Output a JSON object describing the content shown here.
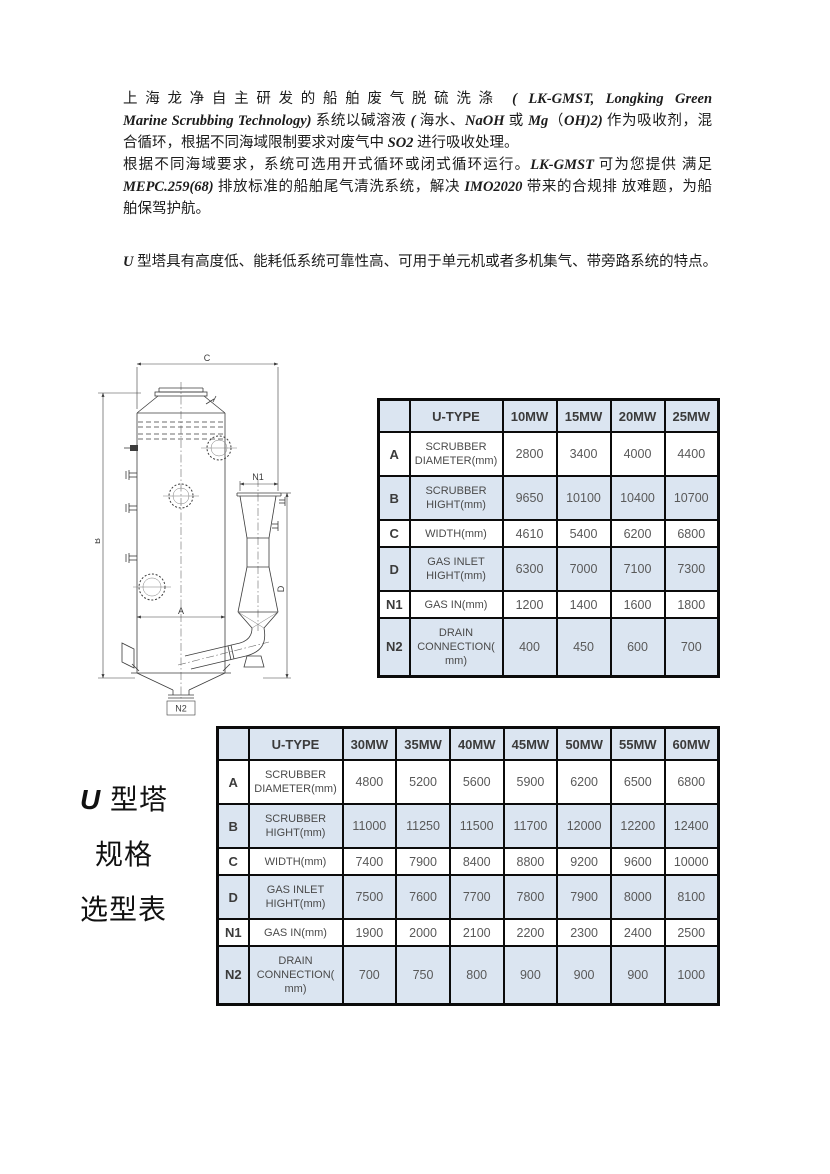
{
  "colors": {
    "table_fill_blue": "#dbe5f1",
    "table_border": "#0b0b0b",
    "value_text": "#595959",
    "body_text": "#1c1c1c"
  },
  "intro": {
    "para1_lines": [
      "上海龙净自主研发的船舶废气脱硫洗涤 ( LK-GMST, Longking Green",
      "Marine Scrubbing Technology) 系统以碱溶液 ( 海水、NaOH 或 Mg（OH)2) 作为吸收剂，混",
      "合循环，根据不同海域限制要求对废气中 SO2 进行吸收处理。"
    ],
    "para2_lines": [
      "根据不同海域要求，系统可选用开式循环或闭式循环运行。LK-GMST 可为您提供 满足",
      "MEPC.259(68) 排放标准的船舶尾气清洗系统，解决 IMO2020 带来的合规排 放难题，为船",
      "舶保驾护航。"
    ],
    "feature_line": "U 型塔具有高度低、能耗低系统可靠性高、可用于单元机或者多机集气、带旁路系统的特点。"
  },
  "drawing": {
    "labels": {
      "c": "C",
      "b": "B",
      "a": "A",
      "d": "D",
      "n1": "N1",
      "n2": "N2"
    }
  },
  "side_label": {
    "lines": [
      "U 型塔",
      "规格",
      "选型表"
    ]
  },
  "table1": {
    "header": [
      "",
      "U-TYPE",
      "10MW",
      "15MW",
      "20MW",
      "25MW"
    ],
    "rows": [
      {
        "key": "A",
        "param": "SCRUBBER DIAMETER(mm)",
        "values": [
          "2800",
          "3400",
          "4000",
          "4400"
        ]
      },
      {
        "key": "B",
        "param": "SCRUBBER HIGHT(mm)",
        "values": [
          "9650",
          "10100",
          "10400",
          "10700"
        ]
      },
      {
        "key": "C",
        "param": "WIDTH(mm)",
        "values": [
          "4610",
          "5400",
          "6200",
          "6800"
        ]
      },
      {
        "key": "D",
        "param": "GAS INLET HIGHT(mm)",
        "values": [
          "6300",
          "7000",
          "7100",
          "7300"
        ]
      },
      {
        "key": "N1",
        "param": "GAS IN(mm)",
        "values": [
          "1200",
          "1400",
          "1600",
          "1800"
        ]
      },
      {
        "key": "N2",
        "param": "DRAIN CONNECTION( mm)",
        "values": [
          "400",
          "450",
          "600",
          "700"
        ]
      }
    ]
  },
  "table2": {
    "header": [
      "",
      "U-TYPE",
      "30MW",
      "35MW",
      "40MW",
      "45MW",
      "50MW",
      "55MW",
      "60MW"
    ],
    "rows": [
      {
        "key": "A",
        "param": "SCRUBBER DIAMETER(mm)",
        "values": [
          "4800",
          "5200",
          "5600",
          "5900",
          "6200",
          "6500",
          "6800"
        ]
      },
      {
        "key": "B",
        "param": "SCRUBBER HIGHT(mm)",
        "values": [
          "11000",
          "11250",
          "11500",
          "11700",
          "12000",
          "12200",
          "12400"
        ]
      },
      {
        "key": "C",
        "param": "WIDTH(mm)",
        "values": [
          "7400",
          "7900",
          "8400",
          "8800",
          "9200",
          "9600",
          "10000"
        ]
      },
      {
        "key": "D",
        "param": "GAS INLET HIGHT(mm)",
        "values": [
          "7500",
          "7600",
          "7700",
          "7800",
          "7900",
          "8000",
          "8100"
        ]
      },
      {
        "key": "N1",
        "param": "GAS IN(mm)",
        "values": [
          "1900",
          "2000",
          "2100",
          "2200",
          "2300",
          "2400",
          "2500"
        ]
      },
      {
        "key": "N2",
        "param": "DRAIN CONNECTION( mm)",
        "values": [
          "700",
          "750",
          "800",
          "900",
          "900",
          "900",
          "1000"
        ]
      }
    ]
  }
}
